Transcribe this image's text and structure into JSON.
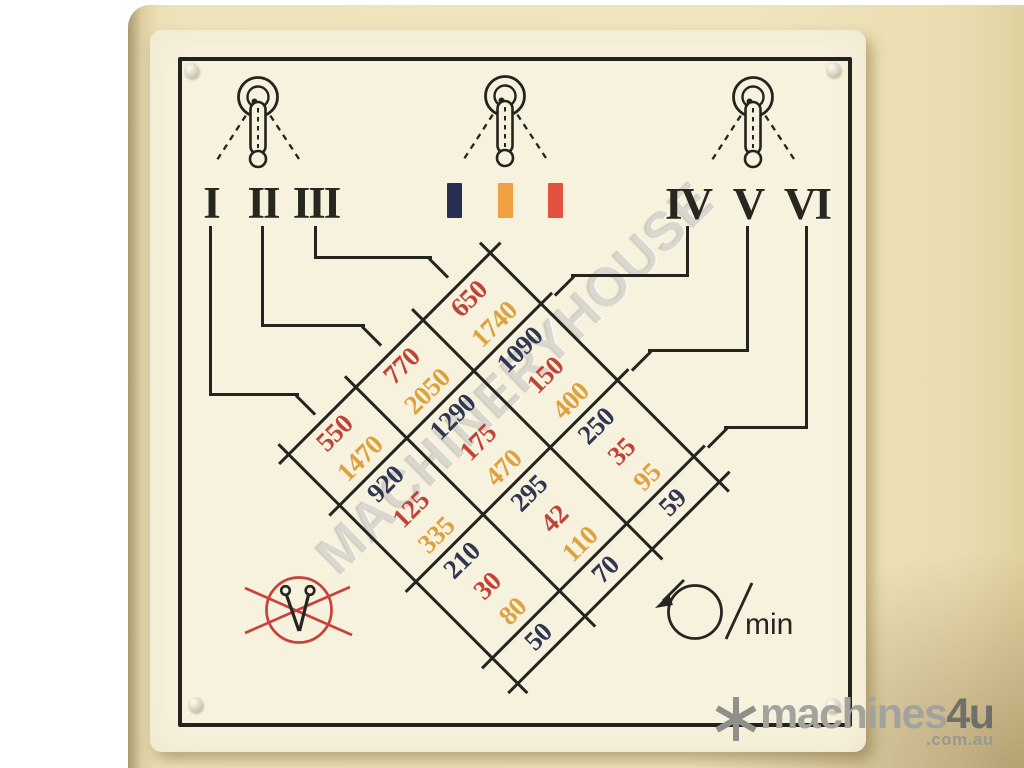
{
  "plate": {
    "left_lever": {
      "positions": [
        "I",
        "II",
        "III"
      ]
    },
    "right_lever": {
      "positions": [
        "IV",
        "V",
        "VI"
      ]
    },
    "middle_lever": {
      "colors": [
        {
          "name": "navy",
          "hex": "#272e52"
        },
        {
          "name": "orange",
          "hex": "#f2a142"
        },
        {
          "name": "red",
          "hex": "#e25240"
        }
      ]
    },
    "rpm_unit": "min"
  },
  "chart_data": {
    "type": "table",
    "title": "Spindle speed selection chart (r/min)",
    "orientation": "grid rotated 45 degrees",
    "palette": {
      "navy": "#303552",
      "red": "#bf4338",
      "orange": "#dda23f"
    },
    "column_groups": [
      2,
      3,
      3,
      1
    ],
    "row_labels": [
      "III",
      "II",
      "I"
    ],
    "rows": [
      {
        "label": "III",
        "cells": [
          {
            "v": "650",
            "c": "red"
          },
          {
            "v": "1740",
            "c": "orange"
          },
          {
            "v": "1090",
            "c": "navy"
          },
          {
            "v": "150",
            "c": "red"
          },
          {
            "v": "400",
            "c": "orange"
          },
          {
            "v": "250",
            "c": "navy"
          },
          {
            "v": "35",
            "c": "red"
          },
          {
            "v": "95",
            "c": "orange"
          },
          {
            "v": "59",
            "c": "navy"
          }
        ]
      },
      {
        "label": "II",
        "cells": [
          {
            "v": "770",
            "c": "red"
          },
          {
            "v": "2050",
            "c": "orange"
          },
          {
            "v": "1290",
            "c": "navy"
          },
          {
            "v": "175",
            "c": "red"
          },
          {
            "v": "470",
            "c": "orange"
          },
          {
            "v": "295",
            "c": "navy"
          },
          {
            "v": "42",
            "c": "red"
          },
          {
            "v": "110",
            "c": "orange"
          },
          {
            "v": "70",
            "c": "navy"
          }
        ]
      },
      {
        "label": "I",
        "cells": [
          {
            "v": "550",
            "c": "red"
          },
          {
            "v": "1470",
            "c": "orange"
          },
          {
            "v": "920",
            "c": "navy"
          },
          {
            "v": "125",
            "c": "red"
          },
          {
            "v": "335",
            "c": "orange"
          },
          {
            "v": "210",
            "c": "navy"
          },
          {
            "v": "30",
            "c": "red"
          },
          {
            "v": "80",
            "c": "orange"
          },
          {
            "v": "50",
            "c": "navy"
          }
        ]
      }
    ],
    "right_connector_labels": [
      "IV",
      "V",
      "VI"
    ]
  },
  "watermarks": {
    "diagonal_text": "MACHINERYHOUSE",
    "logo": {
      "brand": "machines",
      "suffix": "4u",
      "domain": ".com.au"
    }
  }
}
